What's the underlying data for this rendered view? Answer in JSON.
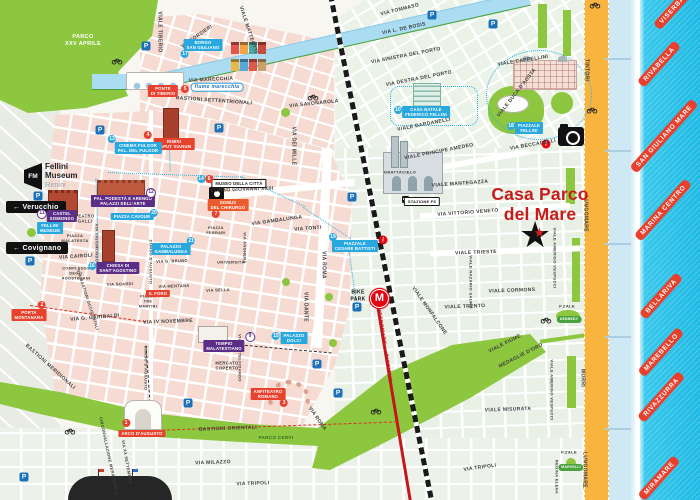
{
  "meta": {
    "app": "Rimini city tourist map",
    "note": "Casa Parco del Mare location map"
  },
  "title": {
    "line1": "Casa Parco",
    "line2": "del Mare"
  },
  "fm_logo": {
    "mark": "FM",
    "line1": "Fellini",
    "line2": "Museum",
    "line3": "Rimini"
  },
  "signs": [
    {
      "label": "← Verucchio"
    },
    {
      "label": "← Covignano"
    }
  ],
  "transit": {
    "station": "STAZIONE FS",
    "metromare": "METROMARE → RICCIONE",
    "bike_park": "BIKE\nPARK",
    "metro_logo": "M"
  },
  "icon_glyphs": {
    "parking": "P",
    "info": "i",
    "metro": "M",
    "star": "★"
  },
  "colors": {
    "sea": "#2ec6ea",
    "park_green": "#8dc63f",
    "block_pink": "#f6dbd2",
    "block_green": "#e9f0e5",
    "road_orange": "#f9b440",
    "rail_black": "#1a1a1a",
    "metromare_red": "#c4161c",
    "label_blue": "#29a8e0",
    "label_purple": "#5b2d86",
    "label_red": "#e8412e",
    "title_red": "#c81b1b",
    "route_cyan": "#2bb1e4"
  },
  "beach_labels": [
    {
      "t": "VISERBA",
      "x": 672,
      "y": 10
    },
    {
      "t": "RIVABELLA",
      "x": 659,
      "y": 64
    },
    {
      "t": "SAN GIULIANO MARE",
      "x": 664,
      "y": 136
    },
    {
      "t": "MARINA CENTRO",
      "x": 663,
      "y": 210
    },
    {
      "t": "BELLARIVA",
      "x": 661,
      "y": 296
    },
    {
      "t": "MAREBELLO",
      "x": 661,
      "y": 352
    },
    {
      "t": "RIVAZZURRA",
      "x": 661,
      "y": 397
    },
    {
      "t": "MIRAMARE",
      "x": 659,
      "y": 478
    }
  ],
  "poi_labels": [
    {
      "t": "PONTE\nDI TIBERIO",
      "bg": "red",
      "x": 163,
      "y": 91,
      "nums": [
        {
          "n": "5",
          "c": "red",
          "dx": 22,
          "dy": -2
        }
      ]
    },
    {
      "t": "RIMINI\nCAPUT VIARUM",
      "bg": "red",
      "x": 174,
      "y": 144,
      "nums": [
        {
          "n": "4",
          "c": "red",
          "dx": -26,
          "dy": -9
        }
      ]
    },
    {
      "t": "BORGO\nSAN GIULIANO",
      "bg": "blue",
      "x": 203,
      "y": 45,
      "nums": [
        {
          "n": "17",
          "c": "blue",
          "dx": -18,
          "dy": 9
        }
      ]
    },
    {
      "t": "CINEMA FULGOR\nPAL. DEL FULGOR",
      "bg": "blue",
      "x": 138,
      "y": 148,
      "nums": [
        {
          "n": "13",
          "c": "blue",
          "dx": -26,
          "dy": -9
        }
      ]
    },
    {
      "t": "CASTEL\nSISMONDO",
      "bg": "purple",
      "x": 62,
      "y": 216,
      "nums": [
        {
          "n": "11",
          "c": "white",
          "dx": -20,
          "dy": -2
        }
      ]
    },
    {
      "t": "FELLINI\nMUSEUM",
      "bg": "blue",
      "x": 50,
      "y": 228
    },
    {
      "t": "PAL. PODESTÀ E ARENGO\nPALAZZI DELL'ARTE",
      "bg": "purple",
      "x": 123,
      "y": 201,
      "nums": [
        {
          "n": "12",
          "c": "white",
          "dx": 28,
          "dy": -8
        }
      ]
    },
    {
      "t": "PIAZZA CAVOUR",
      "bg": "blue",
      "x": 132,
      "y": 214,
      "nums": [
        {
          "n": "20",
          "c": "blue",
          "dx": 22,
          "dy": -1
        }
      ]
    },
    {
      "t": "MUSEO DELLA CITTÀ",
      "bg": "white",
      "x": 239,
      "y": 181,
      "nums": [
        {
          "n": "6",
          "c": "red",
          "dx": -30,
          "dy": -2
        },
        {
          "n": "14",
          "c": "blue",
          "dx": -38,
          "dy": -2
        }
      ]
    },
    {
      "t": "DOMUS\nDEL CHIRURGO",
      "bg": "orange",
      "x": 228,
      "y": 205,
      "nums": [
        {
          "n": "7",
          "c": "red",
          "dx": -12,
          "dy": 9
        }
      ]
    },
    {
      "t": "PALAZZO\nGAMBALUNGA",
      "bg": "blue",
      "x": 171,
      "y": 249,
      "nums": [
        {
          "n": "21",
          "c": "blue",
          "dx": 20,
          "dy": -8
        }
      ]
    },
    {
      "t": "CHIESA DI\nSANT'AGOSTINO",
      "bg": "purple",
      "x": 118,
      "y": 268,
      "nums": [
        {
          "n": "16",
          "c": "blue",
          "dx": -26,
          "dy": -2
        }
      ]
    },
    {
      "t": "TEMPIO\nMALATESTIANO",
      "bg": "purple",
      "x": 224,
      "y": 346,
      "nums": [
        {
          "n": "9",
          "c": "white",
          "dx": 26,
          "dy": -9
        }
      ]
    },
    {
      "t": "PALAZZO\nDOLCI",
      "bg": "blue",
      "x": 294,
      "y": 338,
      "nums": [
        {
          "n": "15",
          "c": "blue",
          "dx": -18,
          "dy": -2
        }
      ]
    },
    {
      "t": "ANFITEATRO\nROMANO",
      "bg": "red",
      "x": 268,
      "y": 394,
      "nums": [
        {
          "n": "3",
          "c": "red",
          "dx": 16,
          "dy": 9
        }
      ]
    },
    {
      "t": "PORTA\nMONTANARA",
      "bg": "red",
      "x": 29,
      "y": 315,
      "nums": [
        {
          "n": "2",
          "c": "red",
          "dx": 13,
          "dy": -10
        }
      ]
    },
    {
      "t": "ARCO D'AUGUSTO",
      "bg": "red",
      "x": 142,
      "y": 431,
      "nums": [
        {
          "n": "1",
          "c": "red",
          "dx": -16,
          "dy": -8
        }
      ]
    },
    {
      "t": "IL FORO",
      "bg": "red",
      "x": 158,
      "y": 291
    },
    {
      "t": "CASA NATALE\nFEDERICO FELLINI",
      "bg": "blue",
      "x": 426,
      "y": 112,
      "nums": [
        {
          "n": "10",
          "c": "blue",
          "dx": -28,
          "dy": -2
        }
      ]
    },
    {
      "t": "PIAZZALE\nFELLINI",
      "bg": "blue",
      "x": 529,
      "y": 128,
      "nums": [
        {
          "n": "18",
          "c": "blue",
          "dx": -18,
          "dy": -2
        }
      ]
    },
    {
      "t": "PIAZZALE\nCESARE BATTISTI",
      "bg": "blue",
      "x": 355,
      "y": 246,
      "nums": [
        {
          "n": "19",
          "c": "blue",
          "dx": -22,
          "dy": -9
        }
      ]
    },
    {
      "t": "STAZIONE FS",
      "bg": "white",
      "x": 422,
      "y": 199,
      "fs": 4
    },
    {
      "t": "KENNEDY",
      "bg": "green",
      "x": 569,
      "y": 316,
      "fs": 3.5
    },
    {
      "t": "MARVELLI",
      "bg": "green",
      "x": 571,
      "y": 464,
      "fs": 3.5
    }
  ],
  "street_labels": [
    {
      "t": "PARCO\nXXV APRILE",
      "x": 83,
      "y": 41,
      "fs": 5.5,
      "cls": "park-t"
    },
    {
      "t": "PARCO CERVI",
      "x": 276,
      "y": 438,
      "fs": 4.5,
      "cls": "parkdark-t"
    },
    {
      "t": "fiume marecchia",
      "x": 217,
      "y": 87,
      "fs": 5,
      "cls": "rpill"
    },
    {
      "t": "VIALE TIBERIO",
      "x": 159,
      "y": 32,
      "r": 90
    },
    {
      "t": "VIA FORZIERI",
      "x": 197,
      "y": 37,
      "r": -35
    },
    {
      "t": "VIA MARECCHIA",
      "x": 211,
      "y": 80,
      "r": -3
    },
    {
      "t": "BASTIONI SETTENTRIONALI",
      "x": 214,
      "y": 101,
      "r": 4
    },
    {
      "t": "VIALE MATTEOTTI",
      "x": 248,
      "y": 30,
      "r": 72
    },
    {
      "t": "VIA DEI MILLE",
      "x": 293,
      "y": 146,
      "r": 90
    },
    {
      "t": "VIA SAVONAROLA",
      "x": 314,
      "y": 104,
      "r": -6
    },
    {
      "t": "VIA TOMMASO",
      "x": 400,
      "y": 10,
      "r": -14
    },
    {
      "t": "VIA L. DE BOSIS",
      "x": 404,
      "y": 29,
      "r": -12
    },
    {
      "t": "VIA SINISTRA DEL PORTO",
      "x": 406,
      "y": 56,
      "r": -11
    },
    {
      "t": "VIA DESTRA DEL PORTO",
      "x": 419,
      "y": 79,
      "r": -11
    },
    {
      "t": "VIALE CAPPELLINI",
      "x": 523,
      "y": 61,
      "r": -9
    },
    {
      "t": "VIALE DUCA D'AOSTA",
      "x": 517,
      "y": 93,
      "r": -52
    },
    {
      "t": "VIA BECCADELLI",
      "x": 533,
      "y": 145,
      "r": -10
    },
    {
      "t": "TINTORI",
      "x": 586,
      "y": 70,
      "r": 90
    },
    {
      "t": "LUNGOMARE",
      "x": 585,
      "y": 214,
      "r": 90
    },
    {
      "t": "VIALE DARDANELLI",
      "x": 424,
      "y": 125,
      "r": -11
    },
    {
      "t": "VIALE PRINCIPE AMEDEO",
      "x": 439,
      "y": 152,
      "r": -11
    },
    {
      "t": "VIALE MANTEGAZZA",
      "x": 460,
      "y": 184,
      "r": -4
    },
    {
      "t": "VIA VITTORIO VENETO",
      "x": 468,
      "y": 213,
      "r": -4
    },
    {
      "t": "GRATTACIELO",
      "x": 400,
      "y": 172,
      "fs": 4
    },
    {
      "t": "VIALE TRIESTE",
      "x": 476,
      "y": 253,
      "r": -2
    },
    {
      "t": "VIALE CORMONS",
      "x": 512,
      "y": 291,
      "r": -2
    },
    {
      "t": "VIALE TRENTO",
      "x": 465,
      "y": 307,
      "r": -2
    },
    {
      "t": "VIALE NAZARIO SAURO",
      "x": 471,
      "y": 282,
      "r": 90,
      "fs": 4
    },
    {
      "t": "VIALE AMERIGO VESPUCCI",
      "x": 555,
      "y": 258,
      "r": 90,
      "fs": 4
    },
    {
      "t": "VIALE AMERIGO VESPUCCI",
      "x": 552,
      "y": 390,
      "r": 90,
      "fs": 4
    },
    {
      "t": "VIALE MONFALCONE",
      "x": 429,
      "y": 311,
      "r": 55
    },
    {
      "t": "MURRI",
      "x": 582,
      "y": 378,
      "r": 90
    },
    {
      "t": "LUNGOMARE",
      "x": 584,
      "y": 470,
      "r": 90
    },
    {
      "t": "VIALE MISURATA",
      "x": 508,
      "y": 410,
      "r": -2
    },
    {
      "t": "VIALE FIUME",
      "x": 505,
      "y": 344,
      "r": -27
    },
    {
      "t": "MEDAGLIE D'ORO",
      "x": 521,
      "y": 356,
      "r": -27
    },
    {
      "t": "REGINA ELENA",
      "x": 557,
      "y": 477,
      "r": 90,
      "fs": 4
    },
    {
      "t": "VIA TRIPOLI",
      "x": 253,
      "y": 484,
      "r": -2
    },
    {
      "t": "VIA TRIPOLI",
      "x": 480,
      "y": 468,
      "r": -8
    },
    {
      "t": "VIA MILAZZO",
      "x": 213,
      "y": 463,
      "r": -2
    },
    {
      "t": "BASTIONI ORIENTALI",
      "x": 228,
      "y": 429,
      "r": -2
    },
    {
      "t": "VIA IV NOVEMBRE",
      "x": 168,
      "y": 322,
      "r": -2
    },
    {
      "t": "VIA G. GARIBALDI",
      "x": 95,
      "y": 318,
      "r": -5
    },
    {
      "t": "BASTIONI MERIDIONALI",
      "x": 50,
      "y": 367,
      "r": 42
    },
    {
      "t": "CIRCONVALLAZIONE MERIDIONALE",
      "x": 109,
      "y": 456,
      "r": 78,
      "fs": 4
    },
    {
      "t": "VIA XX SETTEMBRE",
      "x": 127,
      "y": 462,
      "r": 80,
      "fs": 4
    },
    {
      "t": "CORSO D'AUGUSTO",
      "x": 151,
      "y": 262,
      "r": 90,
      "fs": 4
    },
    {
      "t": "CORSO D'AUGUSTO",
      "x": 146,
      "y": 368,
      "r": 90,
      "fs": 4
    },
    {
      "t": "VIA CASTELFIDARDO",
      "x": 240,
      "y": 358,
      "r": 90,
      "fs": 4
    },
    {
      "t": "CORSO GIOVANNI XXIII",
      "x": 242,
      "y": 190,
      "r": -2
    },
    {
      "t": "VIA GAMBALUNGA",
      "x": 277,
      "y": 221,
      "r": -8
    },
    {
      "t": "VIA TONTI",
      "x": 308,
      "y": 229,
      "r": -4
    },
    {
      "t": "VIA ROMA",
      "x": 323,
      "y": 265,
      "r": 90
    },
    {
      "t": "VIA ROMA",
      "x": 317,
      "y": 419,
      "r": 55
    },
    {
      "t": "VIA DANTE",
      "x": 305,
      "y": 307,
      "r": 90
    },
    {
      "t": "VIA ANGHERÀ",
      "x": 245,
      "y": 248,
      "r": 90,
      "fs": 4
    },
    {
      "t": "VIA CAIROLI",
      "x": 76,
      "y": 257,
      "r": -4
    },
    {
      "t": "VIA G. BRUNO",
      "x": 172,
      "y": 261,
      "r": -2,
      "fs": 4
    },
    {
      "t": "VIA MENTANA",
      "x": 174,
      "y": 286,
      "r": -2,
      "fs": 4
    },
    {
      "t": "VIA SELLA",
      "x": 218,
      "y": 290,
      "r": -2,
      "fs": 4
    },
    {
      "t": "VIA SOARDI",
      "x": 120,
      "y": 284,
      "r": -2,
      "fs": 4
    },
    {
      "t": "UNIVERSITÀ",
      "x": 231,
      "y": 262,
      "fs": 4
    },
    {
      "t": "VIA SIGISMONDO",
      "x": 97,
      "y": 243,
      "r": 90,
      "fs": 4
    },
    {
      "t": "VIA BASTIONI OCCIDENTALI",
      "x": 88,
      "y": 300,
      "r": 72,
      "fs": 4
    },
    {
      "t": "TEATRO\nGALLI",
      "x": 85,
      "y": 219,
      "fs": 4.2
    },
    {
      "t": "PIAZZA\nMALATESTA",
      "x": 75,
      "y": 238,
      "fs": 4
    },
    {
      "t": "COMPLESSO\nDEGLI\nAGOSTINIANI",
      "x": 76,
      "y": 274,
      "fs": 3.8
    },
    {
      "t": "PIAZZA\nTRE\nMARTIRI",
      "x": 148,
      "y": 302,
      "fs": 3.8
    },
    {
      "t": "PIAZZA\nFERRARI",
      "x": 216,
      "y": 231,
      "fs": 3.8
    },
    {
      "t": "MERCATO\nCOPERTO",
      "x": 227,
      "y": 366,
      "fs": 4.2
    },
    {
      "t": "P.ZALE",
      "x": 567,
      "y": 306,
      "fs": 4
    },
    {
      "t": "P.ZALE",
      "x": 569,
      "y": 452,
      "fs": 4
    },
    {
      "t": "BIKE\nPARK",
      "x": 358,
      "y": 296,
      "fs": 5,
      "cls": "bike-t"
    },
    {
      "t": "METROMARE → RICCIONE",
      "x": 384,
      "y": 345,
      "r": 81,
      "fs": 5,
      "cls": "metro-t"
    }
  ],
  "icons": {
    "parking": [
      [
        146,
        46
      ],
      [
        100,
        130
      ],
      [
        219,
        128
      ],
      [
        432,
        15
      ],
      [
        493,
        24
      ],
      [
        38,
        196
      ],
      [
        30,
        261
      ],
      [
        352,
        197
      ],
      [
        357,
        307
      ],
      [
        188,
        403
      ],
      [
        317,
        364
      ],
      [
        338,
        393
      ],
      [
        24,
        477
      ]
    ],
    "bike": [
      [
        117,
        61
      ],
      [
        313,
        97
      ],
      [
        592,
        110
      ],
      [
        595,
        5
      ],
      [
        376,
        411
      ],
      [
        70,
        431
      ],
      [
        546,
        320
      ]
    ],
    "info": [
      [
        546,
        144
      ],
      [
        383,
        240
      ]
    ]
  },
  "routes": [
    {
      "x": 108,
      "y": 172,
      "len": 135,
      "r": 2,
      "c": "cyan"
    },
    {
      "x": 168,
      "y": 107,
      "len": 64,
      "r": 88,
      "c": "cyan"
    },
    {
      "x": 240,
      "y": 176,
      "len": 72,
      "r": 25,
      "c": "cyan"
    },
    {
      "x": 303,
      "y": 207,
      "len": 57,
      "r": 33,
      "c": "cyan"
    },
    {
      "x": 348,
      "y": 243,
      "len": 60,
      "r": 82,
      "c": "cyan"
    },
    {
      "x": 96,
      "y": 178,
      "len": 90,
      "r": 88,
      "c": "cyan"
    },
    {
      "x": 30,
      "y": 305,
      "len": 117,
      "r": 8,
      "c": "red"
    },
    {
      "x": 152,
      "y": 430,
      "len": 245,
      "r": -2,
      "c": "red"
    },
    {
      "x": 146,
      "y": 345,
      "len": 62,
      "r": 86,
      "c": "black"
    },
    {
      "x": 235,
      "y": 344,
      "len": 97,
      "r": 5,
      "c": "black"
    }
  ]
}
